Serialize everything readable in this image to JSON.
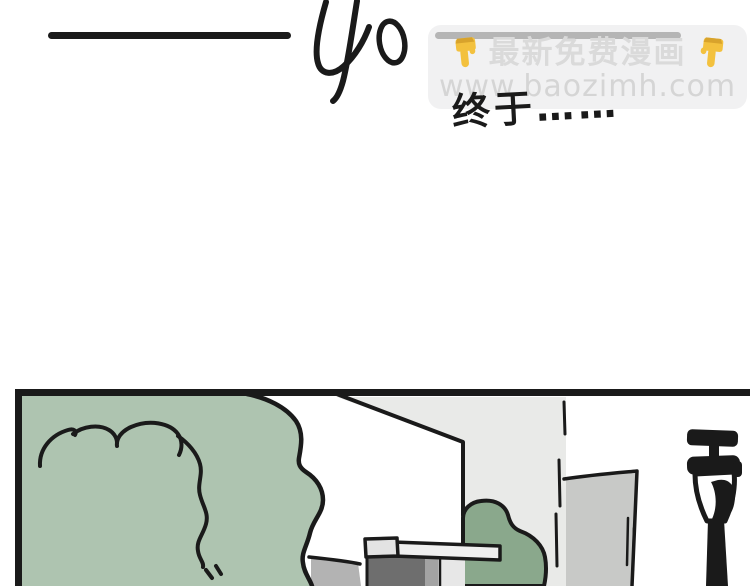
{
  "page": {
    "background": "#ffffff",
    "ink": "#1a1a1a"
  },
  "chapter": {
    "number": "40"
  },
  "watermark": {
    "line1": "最新免费漫画",
    "line2": "www.baozimh.com",
    "emoji_name": "backhand-index-pointing-down",
    "colors": {
      "box_bg": "#f1f1f2",
      "bar": "#b5b5b5",
      "line1_text": "#dadada",
      "line2_text": "#d5d5d5",
      "emoji_main": "#f3c13e",
      "emoji_dark": "#d8a32c"
    }
  },
  "caption": {
    "text": "终于……"
  },
  "panel": {
    "description": "street scene with bushes, building walls and street lamp",
    "colors": {
      "ink": "#1a1a1a",
      "bush_light": "#aec4b0",
      "bush_dark": "#8aa88c",
      "wall_light": "#e9eae8",
      "pillar": "#c8c9c7",
      "wedge": "#b3b3b3",
      "door_dark": "#6e6e6e",
      "door_mid": "#a3a3a3",
      "door_light": "#e7e7e7",
      "ledge": "#efefef",
      "ledge_cap": "#e3e3e3",
      "lamp_body": "#ffffff"
    }
  }
}
